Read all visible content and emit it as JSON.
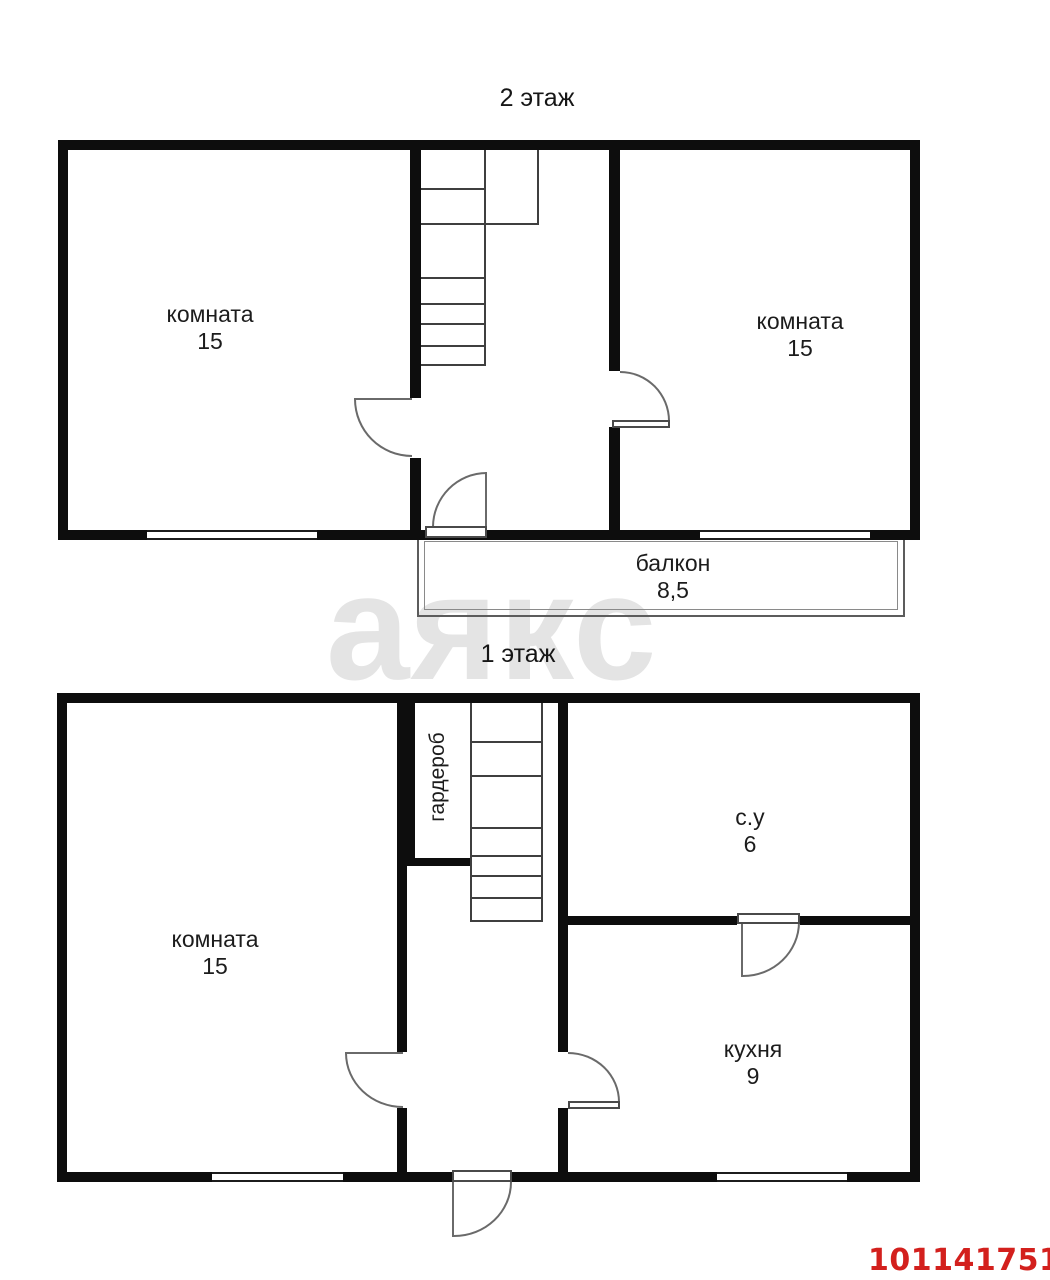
{
  "floor2": {
    "title": "2 этаж",
    "room_left": {
      "label": "комната",
      "area": "15"
    },
    "room_right": {
      "label": "комната",
      "area": "15"
    },
    "balcony": {
      "label": "балкон",
      "area": "8,5"
    }
  },
  "floor1": {
    "title": "1 этаж",
    "room_left": {
      "label": "комната",
      "area": "15"
    },
    "wardrobe": {
      "label": "гардероб"
    },
    "bathroom": {
      "label": "с.у",
      "area": "6"
    },
    "kitchen": {
      "label": "кухня",
      "area": "9"
    }
  },
  "watermark": {
    "text": "аякс"
  },
  "listing": {
    "id": "1011417510"
  },
  "colors": {
    "wall": "#0d0d0d",
    "red": "#d3201d",
    "watermark": "#e4e4e4"
  }
}
